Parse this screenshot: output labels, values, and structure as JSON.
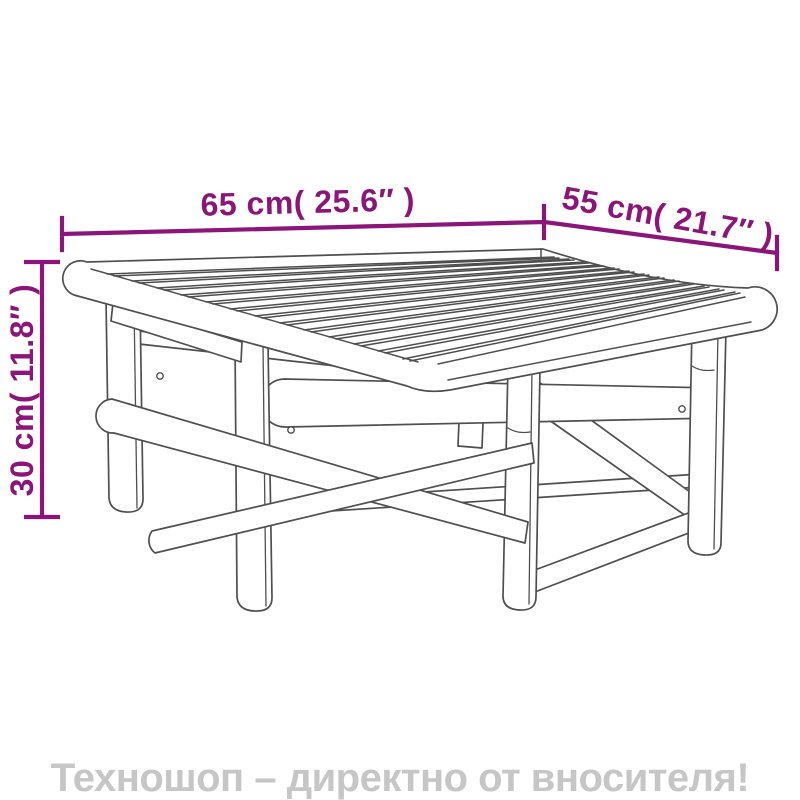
{
  "page": {
    "background_color": "#ffffff",
    "subject": "bamboo coffee table dimension line drawing"
  },
  "dimensions": {
    "color": "#8B1578",
    "width_label": "65 cm( 25.6″ )",
    "depth_label": "55 cm( 21.7″ )",
    "height_label": "30 cm( 11.8″ )"
  },
  "drawing": {
    "stroke_color": "#4f4f4f",
    "slat_count": 13
  },
  "banner": {
    "text": "Техношоп – директно от вносителя!",
    "text_color": "#c6c6c6"
  }
}
